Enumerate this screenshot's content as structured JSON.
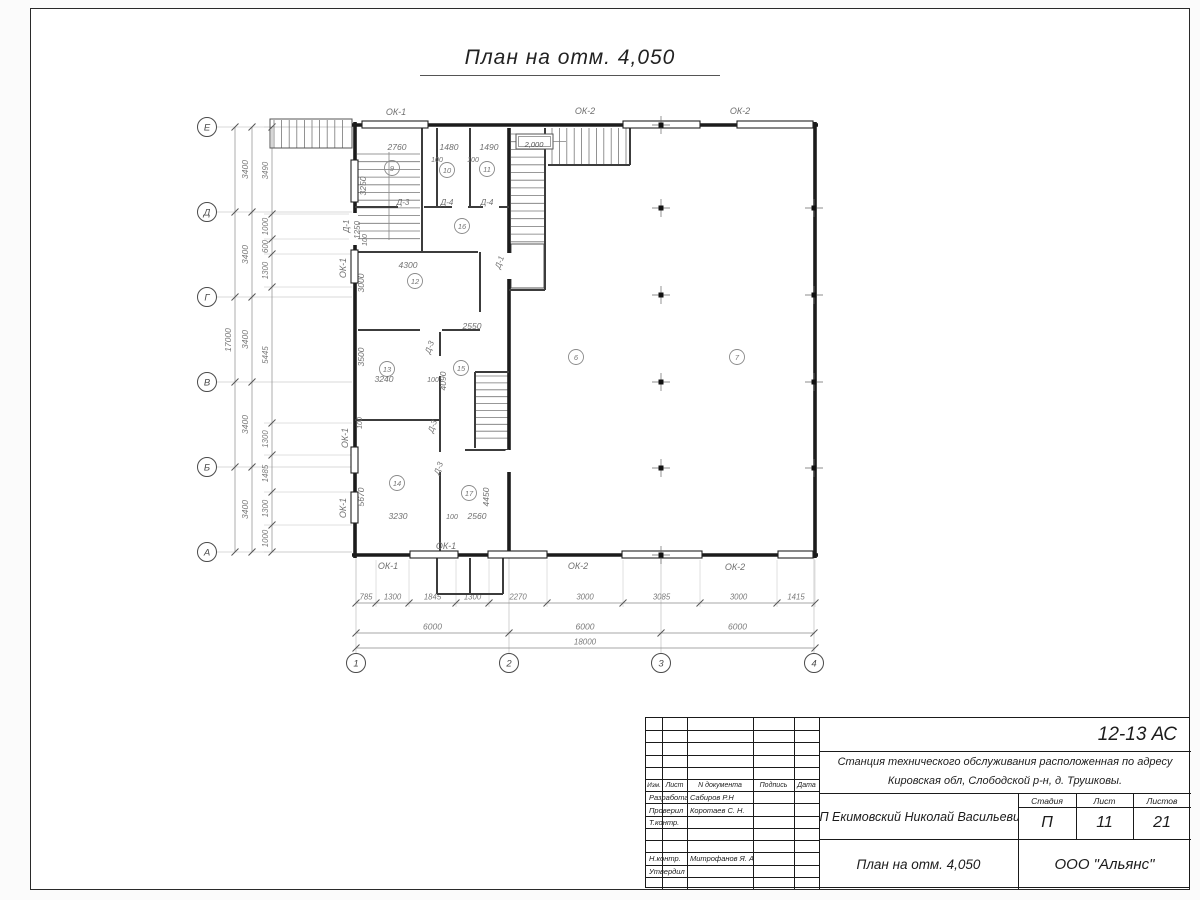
{
  "sheet": {
    "title": "План на отм. 4,050"
  },
  "title_block": {
    "code": "12-13 АС",
    "project_line1": "Станция технического обслуживания расположенная по адресу",
    "project_line2": "Кировская обл, Слободской р-н, д. Трушковы.",
    "client": "ИП Екимовский Николай Васильевич",
    "drawing_title": "План на отм. 4,050",
    "org": "ООО \"Альянс\"",
    "stage_label": "Стадия",
    "stage_value": "П",
    "sheet_label": "Лист",
    "sheet_value": "11",
    "sheets_label": "Листов",
    "sheets_value": "21",
    "header_cols": [
      "Изм.",
      "Лист",
      "N документа",
      "Подпись",
      "Дата"
    ],
    "roles": [
      {
        "label": "Разработал",
        "name": "Сабиров Р.Н"
      },
      {
        "label": "Проверил",
        "name": "Коротаев С. Н."
      },
      {
        "label": "Т.контр.",
        "name": ""
      },
      {
        "label": "Н.контр.",
        "name": "Митрофанов Я. А."
      },
      {
        "label": "Утвердил",
        "name": ""
      }
    ]
  },
  "plan": {
    "colors": {
      "wall": "#1c1c1c",
      "thin": "#3c3c3c",
      "dim": "#8a8a8a",
      "dimtext": "#7a7a7a",
      "label": "#6f6f6f",
      "axis": "#4a4a4a"
    },
    "axis_letters": [
      {
        "l": "Е",
        "y": 127
      },
      {
        "l": "Д",
        "y": 212
      },
      {
        "l": "Г",
        "y": 297
      },
      {
        "l": "В",
        "y": 382
      },
      {
        "l": "Б",
        "y": 467
      },
      {
        "l": "А",
        "y": 552
      }
    ],
    "axis_numbers": [
      {
        "l": "1",
        "x": 356
      },
      {
        "l": "2",
        "x": 509
      },
      {
        "l": "3",
        "x": 661
      },
      {
        "l": "4",
        "x": 814
      }
    ],
    "dim_chains": {
      "left_bays": [
        "3400",
        "3400",
        "3400",
        "3400",
        "3400"
      ],
      "left_total": "17000",
      "left_detail": [
        "3490",
        "1000",
        "600",
        "1300",
        "5445",
        "1300",
        "1485",
        "1300",
        "1000"
      ],
      "bottom_detail": [
        "785",
        "1300",
        "1845",
        "1300",
        "2270",
        "3000",
        "3085",
        "3000",
        "1415"
      ],
      "bottom_bays": [
        "6000",
        "6000",
        "6000"
      ],
      "bottom_total": "18000"
    },
    "elevation_mark": {
      "t": "2,000",
      "x": 534,
      "y": 144
    },
    "rooms": [
      {
        "n": "9",
        "x": 392,
        "y": 168
      },
      {
        "n": "10",
        "x": 447,
        "y": 170
      },
      {
        "n": "11",
        "x": 487,
        "y": 169
      },
      {
        "n": "16",
        "x": 462,
        "y": 226
      },
      {
        "n": "12",
        "x": 415,
        "y": 281
      },
      {
        "n": "15",
        "x": 461,
        "y": 368
      },
      {
        "n": "13",
        "x": 387,
        "y": 369
      },
      {
        "n": "14",
        "x": 397,
        "y": 483
      },
      {
        "n": "17",
        "x": 469,
        "y": 493
      },
      {
        "n": "6",
        "x": 576,
        "y": 357
      },
      {
        "n": "7",
        "x": 737,
        "y": 357
      }
    ],
    "labels": [
      {
        "t": "ОК-1",
        "x": 396,
        "y": 115,
        "r": 0,
        "s": 9
      },
      {
        "t": "ОК-2",
        "x": 585,
        "y": 114,
        "r": 0,
        "s": 9
      },
      {
        "t": "ОК-2",
        "x": 740,
        "y": 114,
        "r": 0,
        "s": 9
      },
      {
        "t": "ОК-1",
        "x": 388,
        "y": 569,
        "r": 0,
        "s": 9
      },
      {
        "t": "ОК-1",
        "x": 446,
        "y": 549,
        "r": 0,
        "s": 9
      },
      {
        "t": "ОК-2",
        "x": 578,
        "y": 569,
        "r": 0,
        "s": 9
      },
      {
        "t": "ОК-2",
        "x": 735,
        "y": 570,
        "r": 0,
        "s": 9
      },
      {
        "t": "ОК-1",
        "x": 346,
        "y": 268,
        "r": -90,
        "s": 9
      },
      {
        "t": "ОК-1",
        "x": 348,
        "y": 438,
        "r": -90,
        "s": 9
      },
      {
        "t": "ОК-1",
        "x": 346,
        "y": 508,
        "r": -90,
        "s": 9
      },
      {
        "t": "Д-1",
        "x": 349,
        "y": 226,
        "r": -90,
        "s": 8
      },
      {
        "t": "1250",
        "x": 360,
        "y": 230,
        "r": -90,
        "s": 8
      },
      {
        "t": "Д-1",
        "x": 502,
        "y": 263,
        "r": -70,
        "s": 8
      },
      {
        "t": "Д-3",
        "x": 403,
        "y": 205,
        "r": 0,
        "s": 8
      },
      {
        "t": "Д-4",
        "x": 447,
        "y": 205,
        "r": 0,
        "s": 8
      },
      {
        "t": "Д-4",
        "x": 487,
        "y": 205,
        "r": 0,
        "s": 8
      },
      {
        "t": "Д-3",
        "x": 432,
        "y": 348,
        "r": -70,
        "s": 8
      },
      {
        "t": "Д-3",
        "x": 435,
        "y": 427,
        "r": -70,
        "s": 8
      },
      {
        "t": "Д-3",
        "x": 441,
        "y": 469,
        "r": -70,
        "s": 8
      },
      {
        "t": "2760",
        "x": 397,
        "y": 150,
        "r": 0,
        "s": 8.5
      },
      {
        "t": "1480",
        "x": 449,
        "y": 150,
        "r": 0,
        "s": 8.5
      },
      {
        "t": "1490",
        "x": 489,
        "y": 150,
        "r": 0,
        "s": 8.5
      },
      {
        "t": "100",
        "x": 437,
        "y": 162,
        "r": 0,
        "s": 7
      },
      {
        "t": "100",
        "x": 473,
        "y": 162,
        "r": 0,
        "s": 7
      },
      {
        "t": "4300",
        "x": 408,
        "y": 268,
        "r": 0,
        "s": 8.5
      },
      {
        "t": "2550",
        "x": 472,
        "y": 329,
        "r": 0,
        "s": 8.5
      },
      {
        "t": "3240",
        "x": 384,
        "y": 382,
        "r": 0,
        "s": 8.5
      },
      {
        "t": "100",
        "x": 433,
        "y": 382,
        "r": 0,
        "s": 7
      },
      {
        "t": "3230",
        "x": 398,
        "y": 519,
        "r": 0,
        "s": 8.5
      },
      {
        "t": "100",
        "x": 452,
        "y": 519,
        "r": 0,
        "s": 7
      },
      {
        "t": "2560",
        "x": 477,
        "y": 519,
        "r": 0,
        "s": 8.5
      },
      {
        "t": "3250",
        "x": 366,
        "y": 186,
        "r": -90,
        "s": 8.5
      },
      {
        "t": "100",
        "x": 367,
        "y": 240,
        "r": -90,
        "s": 7
      },
      {
        "t": "3000",
        "x": 364,
        "y": 283,
        "r": -90,
        "s": 8.5
      },
      {
        "t": "3500",
        "x": 364,
        "y": 357,
        "r": -90,
        "s": 8.5
      },
      {
        "t": "100",
        "x": 362,
        "y": 423,
        "r": -90,
        "s": 7
      },
      {
        "t": "5670",
        "x": 364,
        "y": 497,
        "r": -90,
        "s": 8.5
      },
      {
        "t": "4090",
        "x": 446,
        "y": 381,
        "r": -90,
        "s": 8.5
      },
      {
        "t": "4450",
        "x": 489,
        "y": 497,
        "r": -90,
        "s": 8.5
      }
    ]
  }
}
